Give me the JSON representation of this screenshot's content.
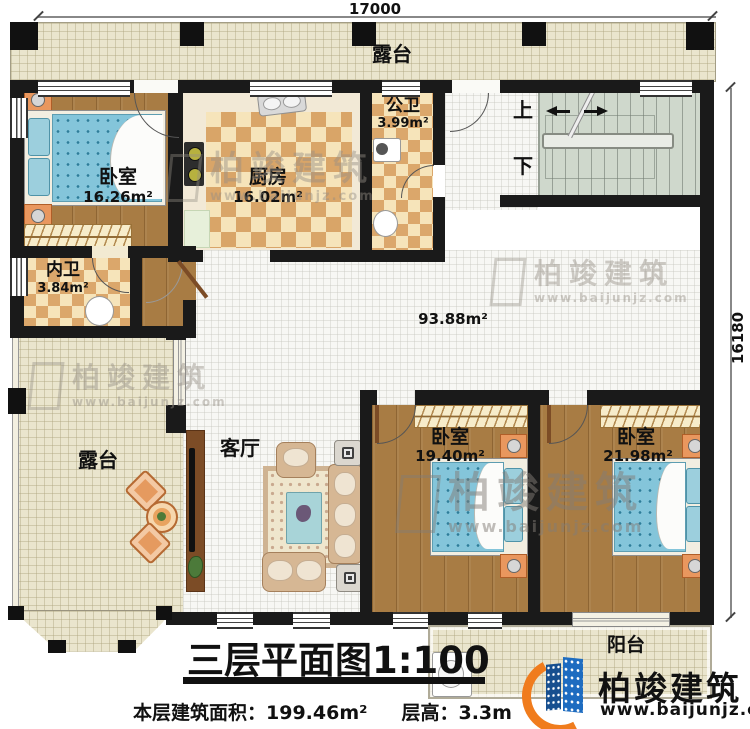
{
  "dimensions": {
    "top": "17000",
    "right": "16180"
  },
  "rooms": {
    "terrace_top": {
      "name": "露台"
    },
    "bedroom1": {
      "name": "卧室",
      "area": "16.26m²"
    },
    "kitchen": {
      "name": "厨房",
      "area": "16.02m²"
    },
    "public_bath": {
      "name": "公卫",
      "area": "3.99m²"
    },
    "inner_bath": {
      "name": "内卫",
      "area": "3.84m²"
    },
    "hall": {
      "area": "93.88m²"
    },
    "living": {
      "name": "客厅"
    },
    "bedroom2": {
      "name": "卧室",
      "area": "19.40m²"
    },
    "bedroom3": {
      "name": "卧室",
      "area": "21.98m²"
    },
    "terrace_left": {
      "name": "露台"
    },
    "balcony": {
      "name": "阳台"
    },
    "stairs": {
      "up": "上",
      "down": "下"
    }
  },
  "title": {
    "text": "三层平面图",
    "scale": "1:100"
  },
  "footer": {
    "area_label": "本层建筑面积：",
    "area_value": "199.46m²",
    "height_label": "层高：",
    "height_value": "3.3m"
  },
  "branding": {
    "brand": "柏竣建筑",
    "url": "www.baijunjz.com",
    "accent_blue": "#1e6cc0",
    "accent_dark_blue": "#174f8f",
    "accent_orange": "#f07c1d"
  },
  "watermark": {
    "brand": "柏竣建筑",
    "url": "www.baijunjz.com"
  }
}
